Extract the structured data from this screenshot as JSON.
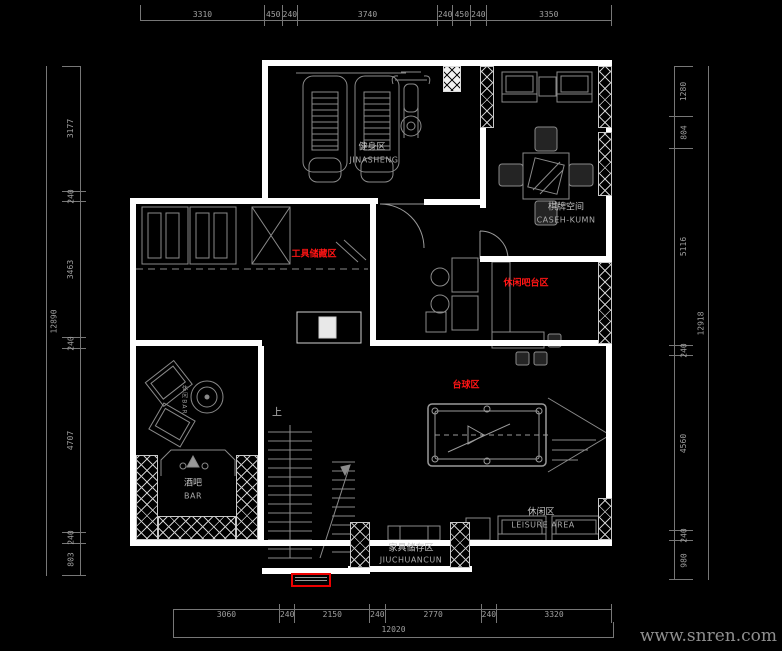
{
  "watermark": "www.snren.com",
  "colors": {
    "background": "#000000",
    "wall": "#ffffff",
    "line": "#8a8a8a",
    "room_label_red": "#ff1414",
    "dim_text": "#a0a0a0"
  },
  "dims": {
    "top": [
      "3310",
      "450",
      "240",
      "3740",
      "240",
      "450",
      "240",
      "3350"
    ],
    "bottom": [
      "3060",
      "240",
      "2150",
      "240",
      "2770",
      "240",
      "3320"
    ],
    "bottom_total": "12020",
    "left": [
      "3177",
      "240",
      "3463",
      "240",
      "4707",
      "240",
      "803"
    ],
    "left_total": "12890",
    "right": [
      "1280",
      "804",
      "5116",
      "240",
      "4560",
      "240",
      "980"
    ],
    "right_total": "12918"
  },
  "rooms": {
    "fitness": {
      "zh": "健身区",
      "en": "JINASHENG"
    },
    "chess": {
      "zh": "棋牌空间",
      "en": "CASEH-KUMN"
    },
    "tool_storage": {
      "zh": "工具储藏区"
    },
    "bar_counter": {
      "zh": "休闲吧台区"
    },
    "billiards": {
      "zh": "台球区"
    },
    "bar": {
      "zh": "酒吧",
      "en": "BAR"
    },
    "leisure": {
      "zh": "休闲区",
      "en": "LEISURE AREA"
    },
    "storage": {
      "zh": "家具储存区",
      "en": "JIUCHUANCUN"
    },
    "lounge": {
      "zh": "休闲BAR"
    },
    "stairs": {
      "up": "上"
    }
  }
}
